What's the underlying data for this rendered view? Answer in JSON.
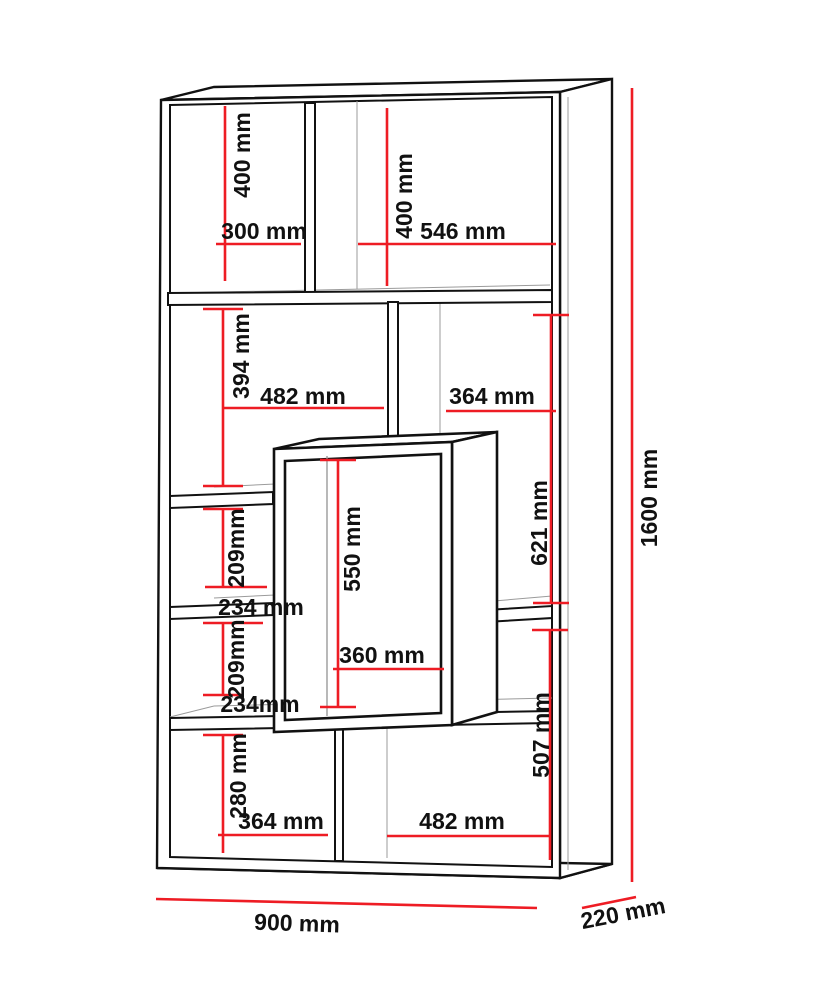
{
  "unit": "mm",
  "colors": {
    "dimension": "#ee1c24",
    "structure": "#111111",
    "depth_lines": "#9b9b9b",
    "text": "#111111",
    "background": "#ffffff"
  },
  "overall_dimensions": {
    "width": "900 mm",
    "height": "1600 mm",
    "depth": "220 mm"
  },
  "labels": [
    {
      "id": "top-left-cell-height",
      "text": "400 mm"
    },
    {
      "id": "top-left-cell-width",
      "text": "300 mm"
    },
    {
      "id": "top-right-cell-height",
      "text": "400 mm"
    },
    {
      "id": "top-right-cell-width",
      "text": "546 mm"
    },
    {
      "id": "mid-left-cell-height",
      "text": "394 mm"
    },
    {
      "id": "mid-left-cell-width",
      "text": "482 mm"
    },
    {
      "id": "mid-right-cell-width",
      "text": "364 mm"
    },
    {
      "id": "left-gap-upper-height",
      "text": "209mm"
    },
    {
      "id": "left-shelf-upper-width",
      "text": "234 mm"
    },
    {
      "id": "center-box-height",
      "text": "550 mm"
    },
    {
      "id": "right-cell-height",
      "text": "621 mm"
    },
    {
      "id": "left-gap-lower-height",
      "text": "209mm"
    },
    {
      "id": "left-shelf-lower-width",
      "text": "234mm"
    },
    {
      "id": "center-box-width",
      "text": "360 mm"
    },
    {
      "id": "right-gap-lower-height",
      "text": "507 mm"
    },
    {
      "id": "bottom-left-cell-height",
      "text": "280 mm"
    },
    {
      "id": "bottom-left-cell-width",
      "text": "364 mm"
    },
    {
      "id": "bottom-right-cell-width",
      "text": "482 mm"
    },
    {
      "id": "overall-height",
      "text": "1600 mm"
    },
    {
      "id": "overall-width",
      "text": "900 mm"
    },
    {
      "id": "overall-depth",
      "text": "220 mm"
    }
  ]
}
